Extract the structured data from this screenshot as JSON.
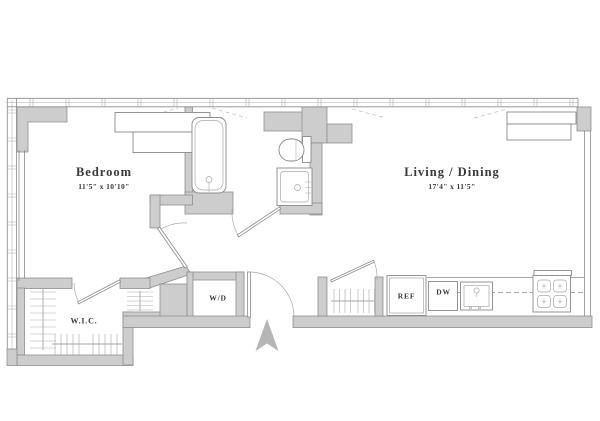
{
  "title": "One-bedroom apartment floor plan",
  "colors": {
    "background": "#ffffff",
    "wall_fill": "#cdcdcd",
    "wall_stroke": "#8e8e8e",
    "line": "#8a8a8a",
    "light_line": "#a9a9a9",
    "dash": "#c4c4c4",
    "text": "#383838",
    "north_arrow": "#b5b5b5"
  },
  "rooms": {
    "bedroom": {
      "label": "Bedroom",
      "dimensions": "11'5\" x 10'10\""
    },
    "living_dining": {
      "label": "Living / Dining",
      "dimensions": "17'4\" x 11'5\""
    },
    "walk_in_closet": {
      "label": "W.I.C."
    }
  },
  "fixtures": {
    "washer_dryer": "W/D",
    "refrigerator": "REF",
    "dishwasher": "DW"
  }
}
